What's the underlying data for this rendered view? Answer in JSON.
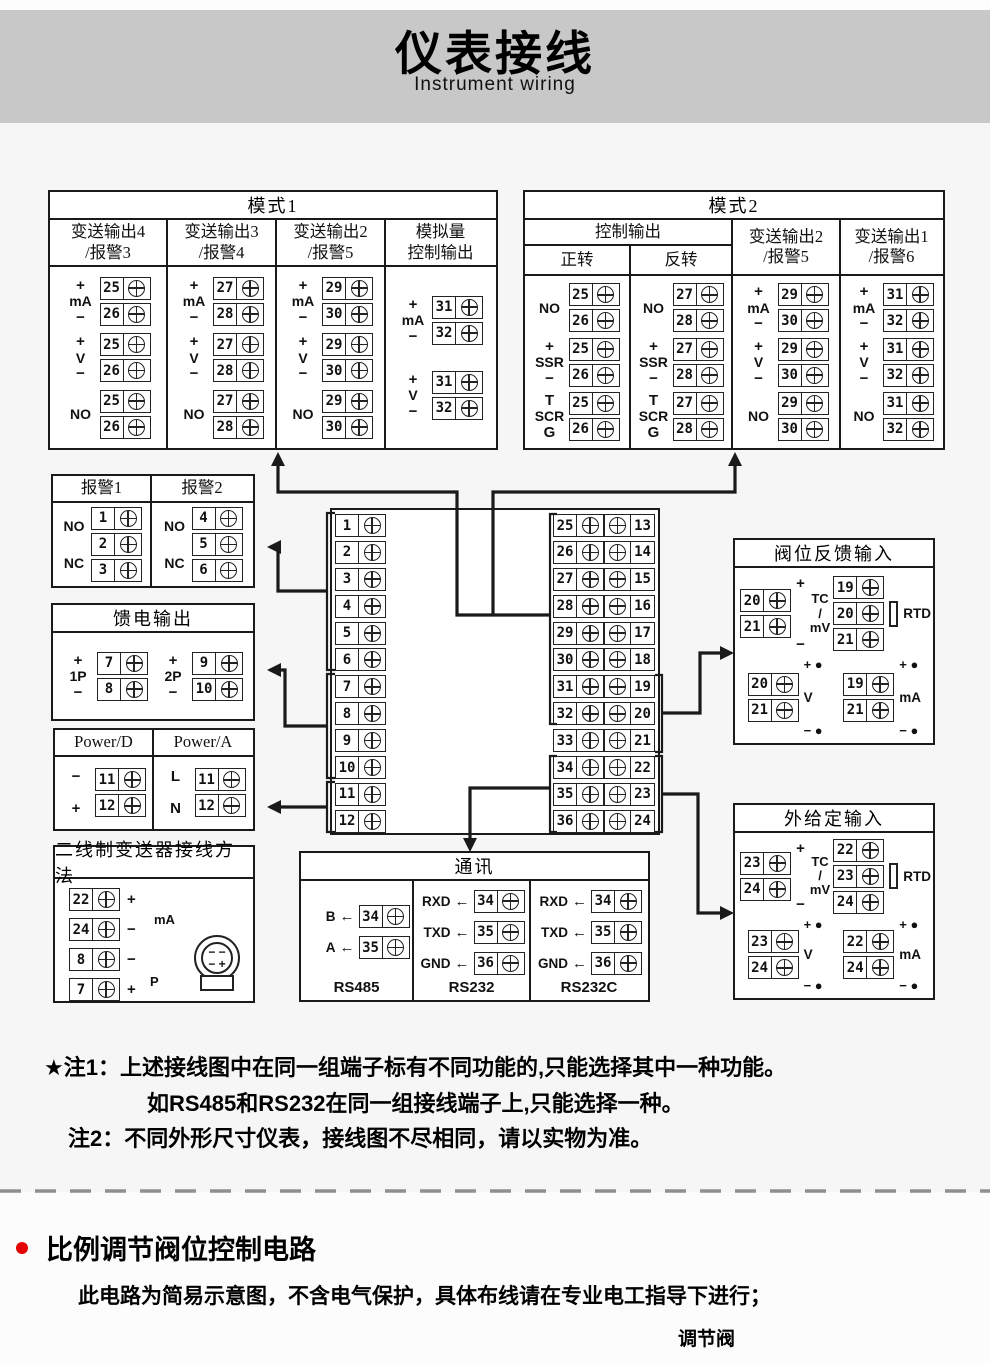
{
  "header": {
    "title": "仪表接线",
    "subtitle": "Instrument wiring"
  },
  "colors": {
    "band_gray": "#c8c8c8",
    "line_ink": "#1a1a1a",
    "accent_red": "#e60000",
    "page_bg": "#f6f6f6"
  },
  "panels": {
    "mode1": {
      "title": "模式1",
      "columns": [
        {
          "header": "变送输出4\n/报警3",
          "groups": [
            {
              "top": "+",
              "mid": "mA",
              "bot": "−",
              "pins": [
                25,
                26
              ]
            },
            {
              "top": "+",
              "mid": "V",
              "bot": "−",
              "pins": [
                25,
                26
              ]
            },
            {
              "mid": "NO",
              "pins": [
                25,
                26
              ]
            }
          ]
        },
        {
          "header": "变送输出3\n/报警4",
          "groups": [
            {
              "top": "+",
              "mid": "mA",
              "bot": "−",
              "pins": [
                27,
                28
              ]
            },
            {
              "top": "+",
              "mid": "V",
              "bot": "−",
              "pins": [
                27,
                28
              ]
            },
            {
              "mid": "NO",
              "pins": [
                27,
                28
              ]
            }
          ]
        },
        {
          "header": "变送输出2\n/报警5",
          "groups": [
            {
              "top": "+",
              "mid": "mA",
              "bot": "−",
              "pins": [
                29,
                30
              ]
            },
            {
              "top": "+",
              "mid": "V",
              "bot": "−",
              "pins": [
                29,
                30
              ]
            },
            {
              "mid": "NO",
              "pins": [
                29,
                30
              ]
            }
          ]
        },
        {
          "header": "模拟量\n控制输出",
          "groups": [
            {
              "top": "+",
              "mid": "mA",
              "bot": "−",
              "pins": [
                31,
                32
              ]
            },
            {
              "top": "+",
              "mid": "V",
              "bot": "−",
              "pins": [
                31,
                32
              ]
            }
          ]
        }
      ]
    },
    "mode2": {
      "title": "模式2",
      "span_header": "控制输出",
      "columns": [
        {
          "header": "正转",
          "groups": [
            {
              "mid": "NO",
              "pins": [
                25,
                26
              ]
            },
            {
              "top": "+",
              "mid": "SSR",
              "bot": "−",
              "pins": [
                25,
                26
              ]
            },
            {
              "top": "T",
              "mid": "SCR",
              "bot": "G",
              "pins": [
                25,
                26
              ]
            }
          ]
        },
        {
          "header": "反转",
          "groups": [
            {
              "mid": "NO",
              "pins": [
                27,
                28
              ]
            },
            {
              "top": "+",
              "mid": "SSR",
              "bot": "−",
              "pins": [
                27,
                28
              ]
            },
            {
              "top": "T",
              "mid": "SCR",
              "bot": "G",
              "pins": [
                27,
                28
              ]
            }
          ]
        },
        {
          "header": "变送输出2\n/报警5",
          "groups": [
            {
              "top": "+",
              "mid": "mA",
              "bot": "−",
              "pins": [
                29,
                30
              ]
            },
            {
              "top": "+",
              "mid": "V",
              "bot": "−",
              "pins": [
                29,
                30
              ]
            },
            {
              "mid": "NO",
              "pins": [
                29,
                30
              ]
            }
          ]
        },
        {
          "header": "变送输出1\n/报警6",
          "groups": [
            {
              "top": "+",
              "mid": "mA",
              "bot": "−",
              "pins": [
                31,
                32
              ]
            },
            {
              "top": "+",
              "mid": "V",
              "bot": "−",
              "pins": [
                31,
                32
              ]
            },
            {
              "mid": "NO",
              "pins": [
                31,
                32
              ]
            }
          ]
        }
      ]
    },
    "alarm": {
      "columns": [
        {
          "header": "报警1",
          "groups": [
            {
              "type": "nonc",
              "top": "NO",
              "bot": "NC",
              "pins": [
                1,
                2,
                3
              ]
            }
          ]
        },
        {
          "header": "报警2",
          "groups": [
            {
              "type": "nonc",
              "top": "NO",
              "bot": "NC",
              "pins": [
                4,
                5,
                6
              ]
            }
          ]
        }
      ]
    },
    "feed": {
      "title": "馈电输出",
      "groups": [
        {
          "top": "+",
          "mid": "1P",
          "bot": "−",
          "pins": [
            7,
            8
          ]
        },
        {
          "top": "+",
          "mid": "2P",
          "bot": "−",
          "pins": [
            9,
            10
          ]
        }
      ]
    },
    "power": {
      "columns": [
        {
          "header": "Power/D",
          "groups": [
            {
              "top": "−",
              "bot": "+",
              "pins": [
                11,
                12
              ]
            }
          ]
        },
        {
          "header": "Power/A",
          "groups": [
            {
              "top": "L",
              "bot": "N",
              "pins": [
                11,
                12
              ]
            }
          ]
        }
      ]
    },
    "twowire": {
      "title": "二线制变送器接线方法",
      "rows": [
        {
          "num": 22,
          "sign": "+"
        },
        {
          "num": 24,
          "sign": "−"
        },
        {
          "num": 8,
          "sign": "−"
        },
        {
          "num": 7,
          "sign": "+"
        }
      ],
      "tag_top": "mA",
      "tag_bottom": "P",
      "transmitter": {
        "line1": "− −",
        "line2": "− +"
      }
    },
    "strip": {
      "left": [
        1,
        2,
        3,
        4,
        5,
        6,
        7,
        8,
        9,
        10,
        11,
        12
      ],
      "rows": [
        [
          25,
          13
        ],
        [
          26,
          14
        ],
        [
          27,
          15
        ],
        [
          28,
          16
        ],
        [
          29,
          17
        ],
        [
          30,
          18
        ],
        [
          31,
          19
        ],
        [
          32,
          20
        ],
        [
          33,
          21
        ],
        [
          34,
          22
        ],
        [
          35,
          23
        ],
        [
          36,
          24
        ]
      ]
    },
    "comm": {
      "title": "通讯",
      "sections": [
        {
          "label": "RS485",
          "pins": [
            {
              "sig": "B",
              "num": 34
            },
            {
              "sig": "A",
              "num": 35
            }
          ]
        },
        {
          "label": "RS232",
          "pins": [
            {
              "sig": "RXD",
              "num": 34
            },
            {
              "sig": "TXD",
              "num": 35
            },
            {
              "sig": "GND",
              "num": 36
            }
          ]
        },
        {
          "label": "RS232C",
          "pins": [
            {
              "sig": "RXD",
              "num": 34
            },
            {
              "sig": "TXD",
              "num": 35
            },
            {
              "sig": "GND",
              "num": 36
            }
          ]
        }
      ]
    },
    "valve": {
      "title": "阀位反馈输入",
      "quads": [
        {
          "type": "sig",
          "pins": [
            20,
            21
          ],
          "top": "+",
          "bot": "−",
          "label": "TC\n/\nmV"
        },
        {
          "type": "rtd",
          "pins": [
            19,
            20,
            21
          ],
          "label": "RTD"
        },
        {
          "type": "dot",
          "pins": [
            20,
            21
          ],
          "top": "+",
          "bot": "−",
          "label": "V"
        },
        {
          "type": "dot",
          "pins": [
            19,
            21
          ],
          "top": "+",
          "bot": "−",
          "label": "mA"
        }
      ]
    },
    "ext": {
      "title": "外给定输入",
      "quads": [
        {
          "type": "sig",
          "pins": [
            23,
            24
          ],
          "top": "+",
          "bot": "−",
          "label": "TC\n/\nmV"
        },
        {
          "type": "rtd",
          "pins": [
            22,
            23,
            24
          ],
          "label": "RTD"
        },
        {
          "type": "dot",
          "pins": [
            23,
            24
          ],
          "top": "+",
          "bot": "−",
          "label": "V"
        },
        {
          "type": "dot",
          "pins": [
            22,
            24
          ],
          "top": "+",
          "bot": "−",
          "label": "mA"
        }
      ]
    }
  },
  "notes": {
    "n1_label": "★注1：",
    "n1_text": "上述接线图中在同一组端子标有不同功能的,只能选择其中一种功能。",
    "n1_text2": "如RS485和RS232在同一组接线端子上,只能选择一种。",
    "n2_label": "注2：",
    "n2_text": "不同外形尺寸仪表，接线图不尽相同，请以实物为准。"
  },
  "bottom": {
    "heading": "比例调节阀位控制电路",
    "para": "此电路为简易示意图，不含电气保护，具体布线请在专业电工指导下进行；",
    "valve_label": "调节阀"
  }
}
